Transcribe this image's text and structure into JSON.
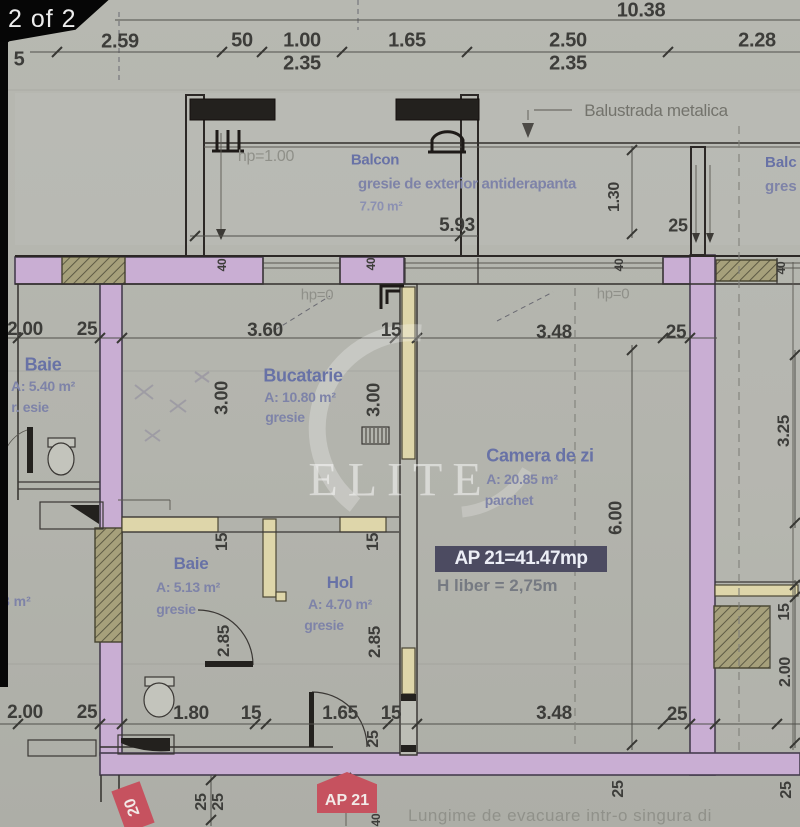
{
  "viewer": {
    "page_indicator": "2 of 2"
  },
  "watermark": {
    "text": "ELITE"
  },
  "balcony": {
    "hp": "hp=1.00",
    "name": "Balcon",
    "finish": "gresie de exterior antiderapanta",
    "area": "7.70 m²",
    "balustrade": "Balustrada metalica"
  },
  "balcony_right": {
    "name": "Balc",
    "finish": "gres"
  },
  "hp_labels": {
    "left": "hp=0",
    "right": "hp=0"
  },
  "rooms": {
    "baie1": {
      "name": "Baie",
      "area": "A: 5.40 m²",
      "finish": "r. esie"
    },
    "bucatarie": {
      "name": "Bucatarie",
      "area": "A: 10.80 m²",
      "finish": "gresie"
    },
    "camera": {
      "name": "Camera de zi",
      "area": "A: 20.85 m²",
      "finish": "parchet"
    },
    "baie2": {
      "name": "Baie",
      "area": "A: 5.13 m²",
      "finish": "gresie"
    },
    "hol": {
      "name": "Hol",
      "area": "A: 4.70 m²",
      "finish": "gresie"
    },
    "neighbor": {
      "partial1": "l",
      "partial2": "8 m²"
    }
  },
  "summary": {
    "area_box": "AP 21=41.47mp",
    "height": "H liber = 2,75m"
  },
  "tags": {
    "apartment": "AP 21",
    "unit": "20"
  },
  "note": "Lungime de evacuare intr-o singura di",
  "dims": {
    "total": "10.38",
    "top": [
      "2.59",
      "50",
      "1.00",
      "1.65",
      "2.50",
      "2.28"
    ],
    "top_sub": [
      "2.35",
      "2.35"
    ],
    "top_left_partial": "5",
    "balcony_width": "5.93",
    "balcony_depth": "1.30",
    "wall_25": "25",
    "mid": [
      "2.00",
      "25",
      "3.60",
      "15",
      "3.48",
      "25"
    ],
    "bottom": [
      "2.00",
      "25",
      "1.80",
      "15",
      "1.65",
      "15",
      "3.48",
      "25"
    ],
    "v_300": "3.00",
    "v_600": "6.00",
    "v_325": "3.25",
    "v_15": "15",
    "v_200": "2.00",
    "v_285": "2.85",
    "wall_40": "40",
    "v_25": "25"
  },
  "colors": {
    "wall_purple": "#c9aed3",
    "wall_cream": "#ded6aa",
    "hatch_olive": "#a6a07b",
    "tag_red": "#c6525f",
    "summary_bg": "#4c4b61"
  }
}
